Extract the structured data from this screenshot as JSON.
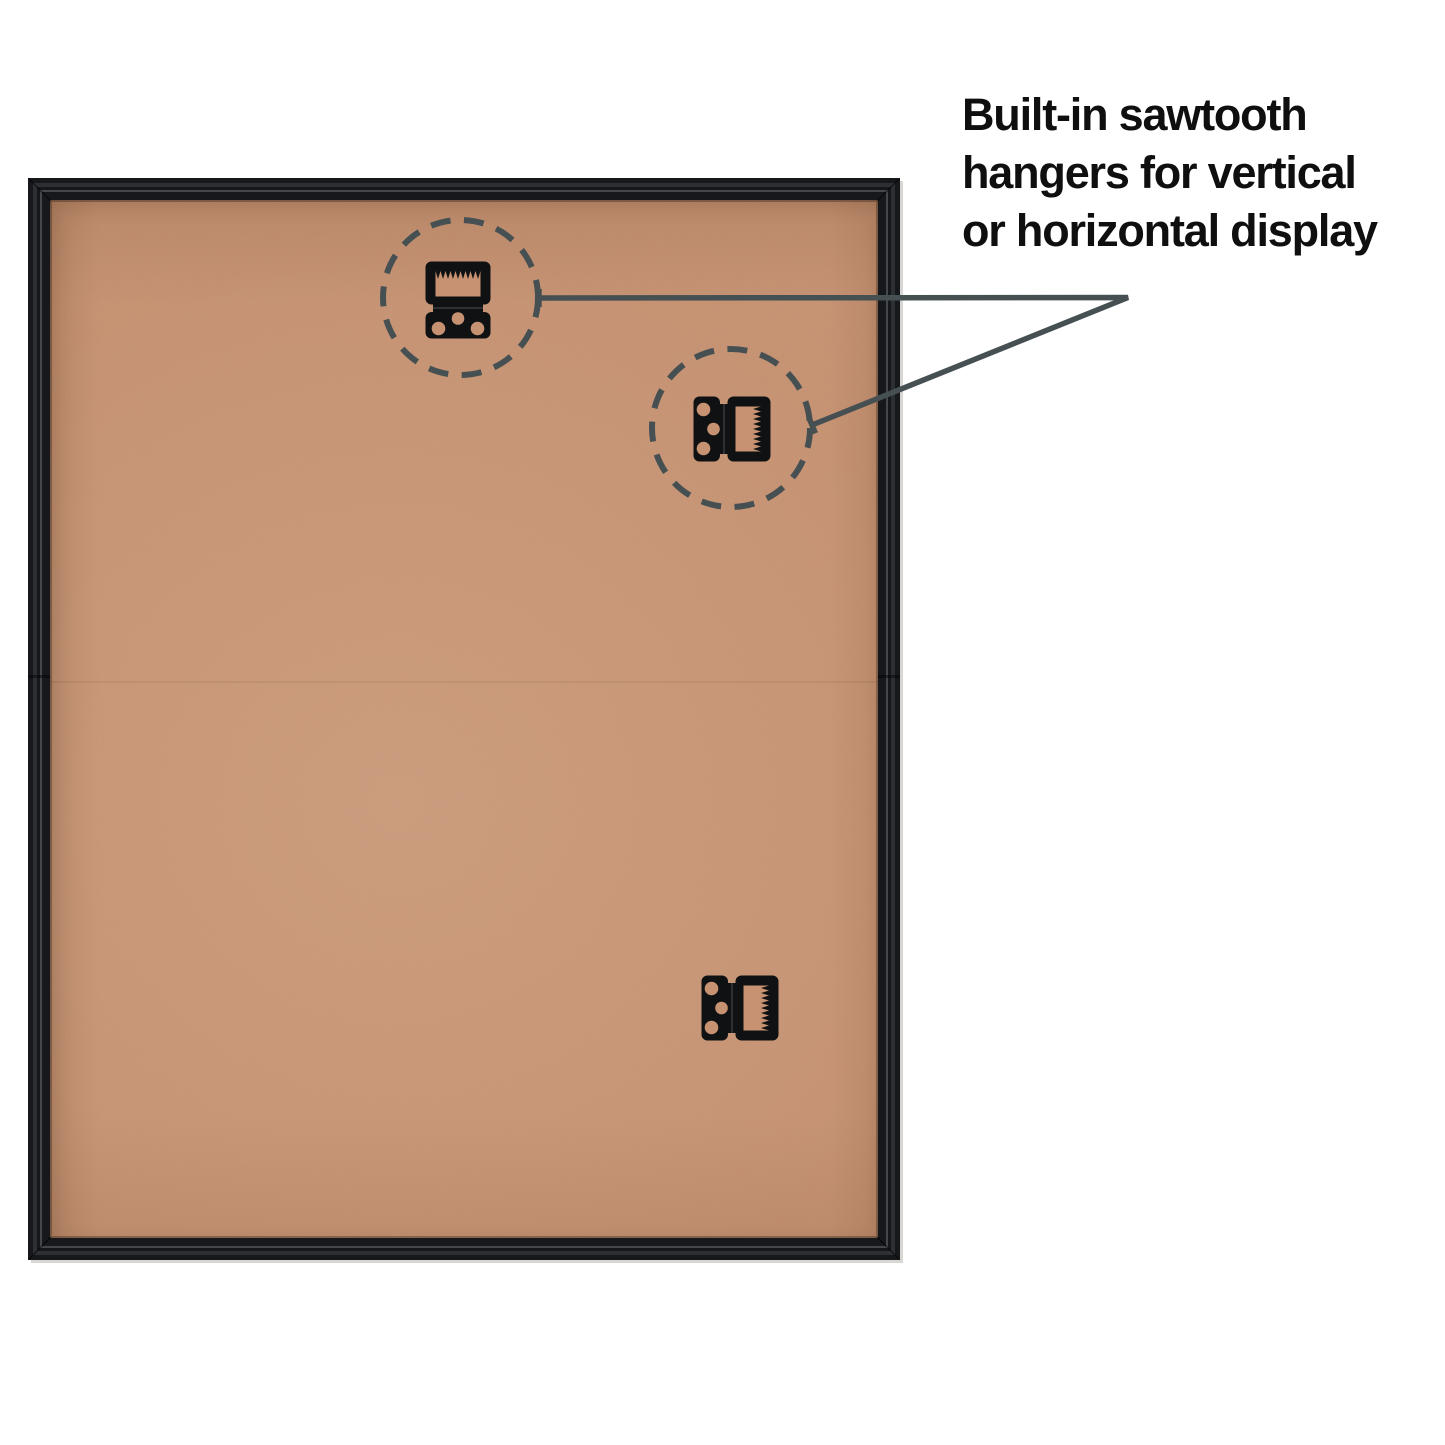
{
  "callout": {
    "text_lines": [
      "Built-in sawtooth",
      "hangers for vertical",
      "or horizontal display"
    ]
  },
  "icons": {
    "hanger_top": "sawtooth-hanger-icon",
    "hanger_right": "sawtooth-hanger-icon",
    "hanger_bottom": "sawtooth-hanger-icon"
  },
  "colors": {
    "background": "#ffffff",
    "textColor": "#0f0f0f",
    "annotation": "#465052",
    "frameBlack": "#17181b",
    "backingTan": "#c69271",
    "hangerBlack": "#101113"
  }
}
